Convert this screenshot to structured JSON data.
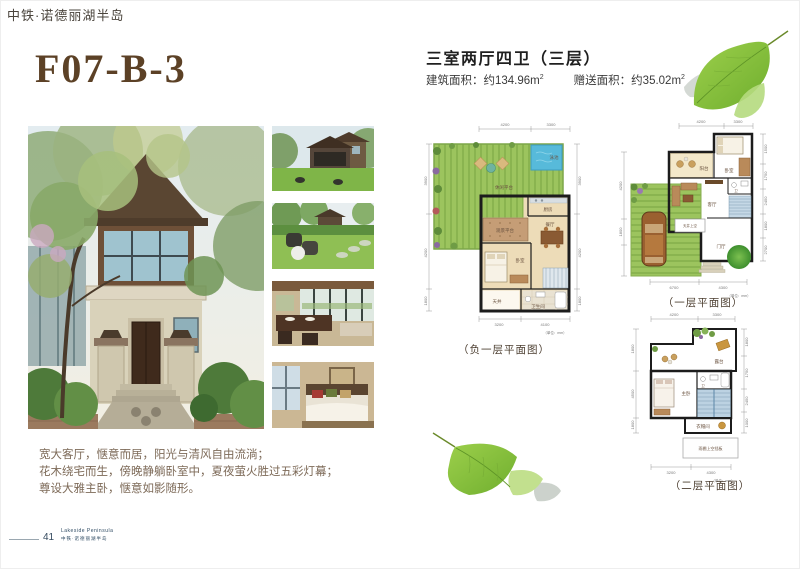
{
  "page": {
    "brand_header": "中铁·诺德丽湖半岛",
    "unit_code": "F07-B-3",
    "page_number": "41",
    "logo_en": "Lakeside Peninsula",
    "logo_cn": "中铁·诺德丽湖半岛"
  },
  "unit_info": {
    "title": "三室两厅四卫（三层）",
    "built_area": "建筑面积：约134.96m",
    "gift_area": "赠送面积：约35.02m",
    "sup": "2"
  },
  "description": {
    "line1": "宽大客厅，惬意而居，阳光与清风自由流淌；",
    "line2": "花木绕宅而生，傍晚静躺卧室中，夏夜萤火胜过五彩灯幕；",
    "line3": "尊设大雅主卧，惬意如影随形。"
  },
  "floor_plans": [
    {
      "label": "（负一层平面图）",
      "unit_note": "（单位：mm）",
      "rooms": {
        "garden": "休闲平台",
        "pool": "泳池",
        "kitchen": "厨房",
        "platform": "观景平台",
        "dining": "餐厅",
        "bedroom": "卧室",
        "patio": "天井",
        "bath": "卫生间"
      },
      "dims": {
        "top": [
          "4200",
          "3300"
        ],
        "bottom": [
          "3200",
          "4100"
        ],
        "left": [
          "3900",
          "4200",
          "1800"
        ],
        "right": [
          "3900",
          "4200",
          "1800"
        ]
      }
    },
    {
      "label": "（一层平面图）",
      "unit_note": "（单位：mm）",
      "rooms": {
        "balcony": "阳台",
        "bedroom": "卧室",
        "bath": "卫",
        "living": "客厅",
        "patio": "天井上空",
        "foyer": "门厅"
      },
      "dims": {
        "top": [
          "4200",
          "3300"
        ],
        "bottom": [
          "6700",
          "4300"
        ],
        "left": [
          "4200",
          "1800"
        ],
        "right": [
          "1500",
          "1750",
          "2450",
          "1800",
          "2700"
        ]
      }
    },
    {
      "label": "（二层平面图）",
      "unit_note": "（单位：mm）",
      "rooms": {
        "terrace": "露台",
        "master": "主卧",
        "bath": "卫",
        "cloak": "衣帽间",
        "canopy": "雨棚上空挡板"
      },
      "dims": {
        "top": [
          "4200",
          "3300"
        ],
        "bottom": [
          "3200",
          "4300"
        ],
        "left": [
          "1800",
          "4500",
          "1800"
        ],
        "right": [
          "1800",
          "1750",
          "2450",
          "1000"
        ]
      }
    }
  ],
  "colors": {
    "title_brown": "#5c4126",
    "text_brown": "#7d6a58",
    "garden_green": "#9cc45e",
    "pool_blue": "#57bada",
    "floor_tan": "#eddcb8",
    "floor_pink": "#f2d9d0",
    "stairs_blue": "#bcd2e2",
    "logo_navy": "#2e4a62"
  }
}
